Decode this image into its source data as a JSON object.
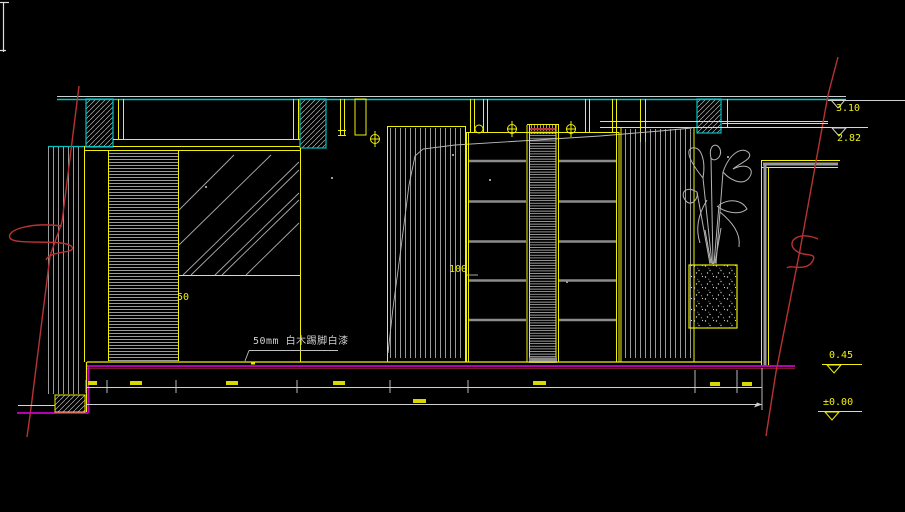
{
  "drawing": {
    "type": "cad-interior-elevation",
    "levels": {
      "top": "3.10",
      "ceiling": "2.82",
      "platform": "0.45",
      "floor": "±0.00"
    },
    "dims": {
      "mirror_reveal": "50",
      "shelf_depth": "100"
    },
    "notes": {
      "skirting": "50mm 白木踢脚白漆"
    },
    "colors": {
      "background": "#000000",
      "ceiling_line": "#00c2c2",
      "frame_yellow": "#f0f00a",
      "floor_magenta": "#cc00cc",
      "section_red": "#b83232",
      "linework_white": "#c8c8c8",
      "shelf_gray": "#8c8c8c"
    }
  }
}
